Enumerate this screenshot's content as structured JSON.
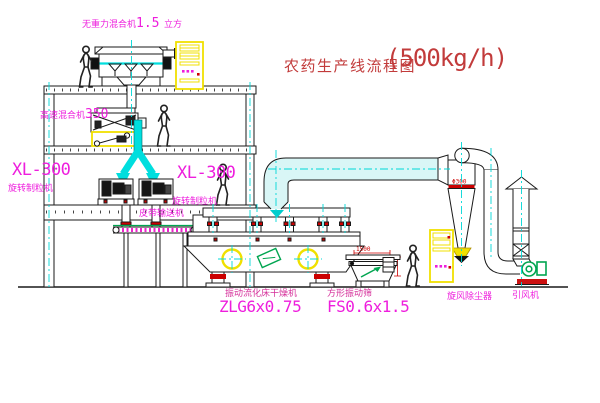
{
  "title": {
    "text": "农药生产线流程图",
    "capacity": "(500kg/h)"
  },
  "labels": {
    "gravity_mixer": {
      "name": "无重力混合机",
      "num": "1.5",
      "unit": "立方"
    },
    "high_speed_mixer": {
      "name": "高速混合机",
      "num": "350"
    },
    "granulator_left": {
      "model": "XL-300",
      "name": "旋转制粒机"
    },
    "granulator_right": {
      "model": "XL-300",
      "name": "旋转制粒机"
    },
    "belt_conveyor": {
      "name": "皮带输送机"
    },
    "dryer": {
      "name": "振动流化床干燥机",
      "model": "ZLG6x0.75"
    },
    "sieve": {
      "name": "方形振动筛",
      "model": "FS0.6x1.5",
      "dimension": "1500"
    },
    "cyclone": {
      "name": "旋风除尘器",
      "size": "Φ300"
    },
    "fan": {
      "name": "引风机"
    }
  },
  "colors": {
    "label_magenta": "#ee1edd",
    "title_red": "#c23b3b",
    "centerline_cyan": "#00d8d8",
    "pipe_cyan": "#00dede",
    "cabinet_yellow": "#f0e000",
    "flange_red": "#cc0000",
    "machine_green": "#00a550",
    "line_black": "#1a1a1a"
  }
}
